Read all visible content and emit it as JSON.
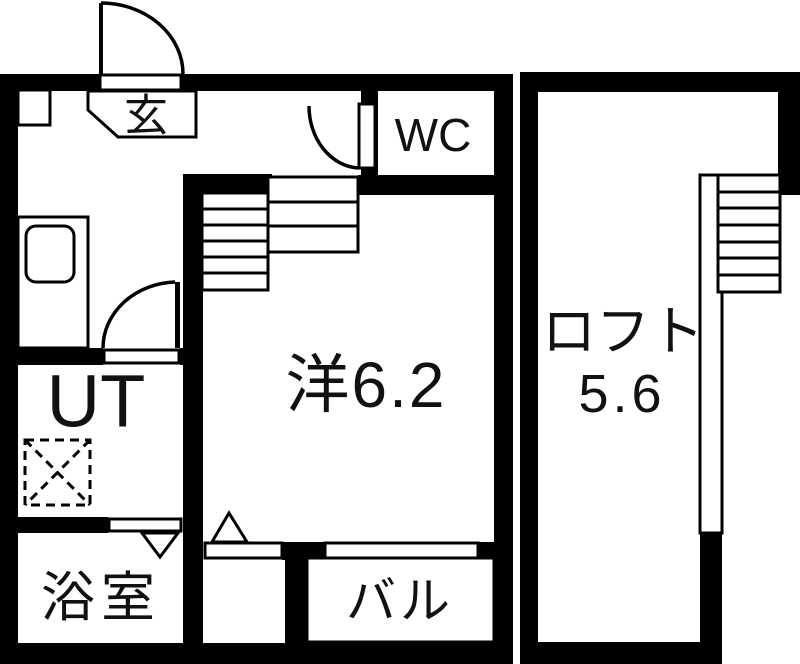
{
  "figure": {
    "type": "floor-plan",
    "description": "Japanese one-room apartment floor plan with loft"
  },
  "colors": {
    "wall": "#000000",
    "background": "#ffffff",
    "ink": "#111111"
  },
  "labels": {
    "entrance": "玄",
    "toilet": "WC",
    "utility": "UT",
    "bathroom": "浴室",
    "western_room": "洋6.2",
    "balcony": "バル",
    "loft_name": "ロフト",
    "loft_size": "5.6"
  }
}
